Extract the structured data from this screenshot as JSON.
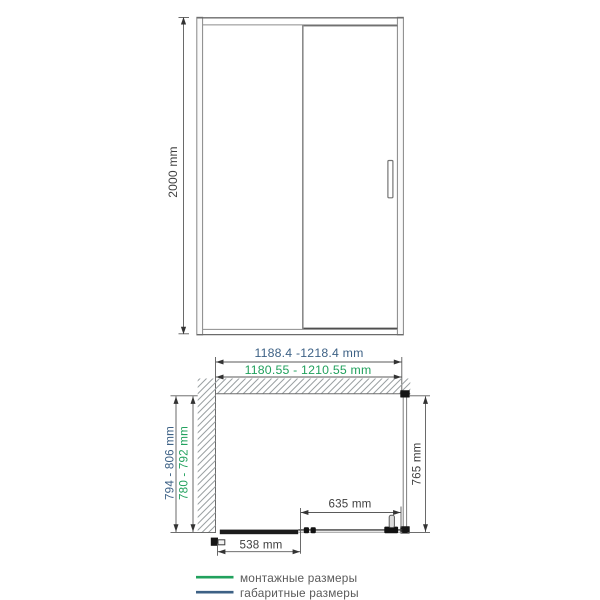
{
  "front_view": {
    "height": "2000 mm",
    "overall_width": "1188.4 -1218.4 mm",
    "mounting_width": "1180.55 - 1210.55 mm"
  },
  "plan_view": {
    "overall_depth": "794 - 806 mm",
    "mounting_depth": "780 - 792 mm",
    "side_depth": "765 mm",
    "door_width": "635 mm",
    "fixed_width": "538 mm"
  },
  "legend": {
    "items": [
      {
        "label": "монтажные размеры",
        "color": "#21a15d"
      },
      {
        "label": "габаритные размеры",
        "color": "#3d6185"
      }
    ]
  },
  "colors": {
    "mounting_green": "#21a15d",
    "overall_blue": "#3d6185",
    "dimension_text": "#3f3f3f",
    "legend_text": "#5a5a5a",
    "drawing_line": "#8c8c8c"
  }
}
